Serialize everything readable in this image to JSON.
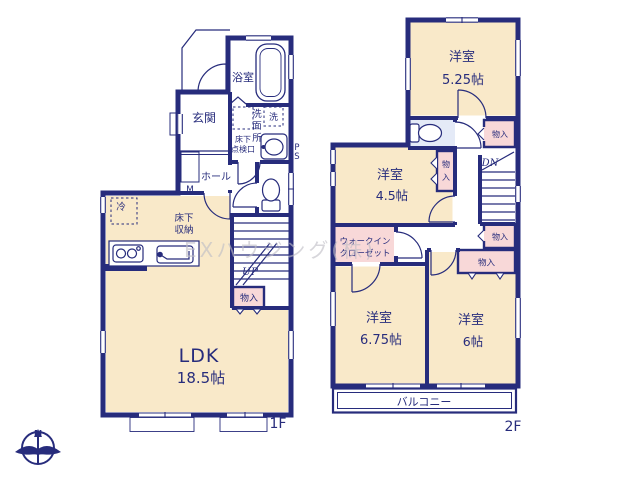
{
  "watermark": "EXハウジング(株)",
  "compass": {
    "north_label": "N"
  },
  "colors": {
    "wall": "#272c7c",
    "room_fill": "#f9e9c9",
    "closet_fill": "#f8d8d8",
    "wet_area_fill": "#e4eaf7",
    "watermark": "#bfbec6"
  },
  "floor1": {
    "floor_label": "1F",
    "entrance": "玄関",
    "hall": "ホール",
    "bathroom": "浴室",
    "washroom_chars": {
      "c1": "洗",
      "c2": "面",
      "c3": "所"
    },
    "washer": "洗",
    "underfloor_hatch": {
      "line1": "床下",
      "line2": "点検口"
    },
    "underfloor_storage": {
      "line1": "床下",
      "line2": "収納"
    },
    "fridge": "冷",
    "meter": "M",
    "pipe_space": {
      "line1": "P",
      "line2": "S"
    },
    "stairs_up": "UP",
    "closet": "物入",
    "ldk": {
      "name": "LDK",
      "size": "18.5帖"
    }
  },
  "floor2": {
    "floor_label": "2F",
    "room_525": {
      "name": "洋室",
      "size": "5.25帖"
    },
    "room_45": {
      "name": "洋室",
      "size": "4.5帖"
    },
    "room_675": {
      "name": "洋室",
      "size": "6.75帖"
    },
    "room_6": {
      "name": "洋室",
      "size": "6帖"
    },
    "wic": {
      "line1": "ウォークイン",
      "line2": "クローゼット"
    },
    "stairs_down": "DN",
    "closet_a": "物入",
    "closet_b_chars": {
      "c1": "物",
      "c2": "入"
    },
    "closet_c": "物入",
    "closet_d": "物入",
    "balcony": "バルコニー"
  }
}
